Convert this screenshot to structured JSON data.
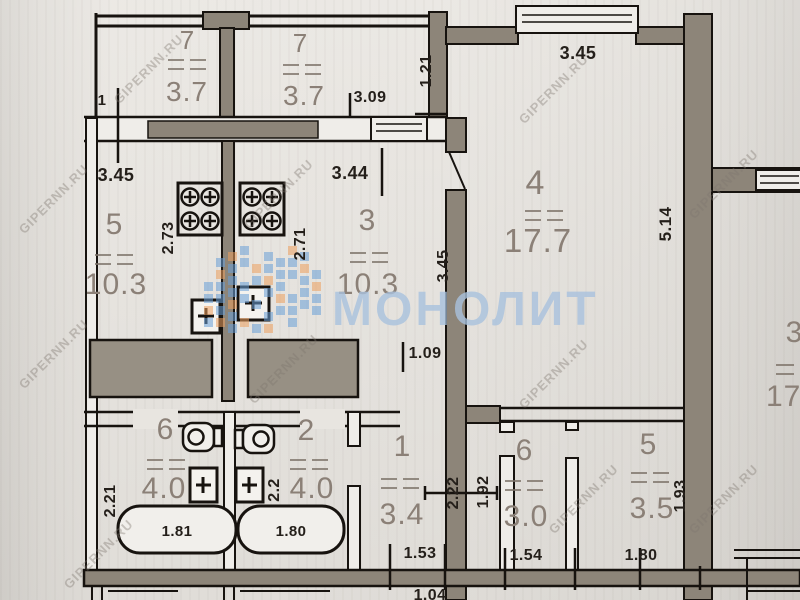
{
  "watermarks": {
    "brand_text": "МОНОЛИТ",
    "brand_color": "#a9c2de",
    "site_text": "GIPERNN.RU"
  },
  "rooms": {
    "balcony_left": {
      "number": "7",
      "area": "3.7"
    },
    "balcony_right": {
      "number": "7",
      "area": "3.7"
    },
    "room_left": {
      "number": "5",
      "area": "10.3"
    },
    "kitchen": {
      "number": "3",
      "area": "10.3"
    },
    "living": {
      "number": "4",
      "area": "17.7"
    },
    "bath_left": {
      "number": "6",
      "area": "4.0"
    },
    "bath_right": {
      "number": "2",
      "area": "4.0"
    },
    "hall": {
      "number": "1",
      "area": "3.4"
    },
    "wc_right_a": {
      "number": "6",
      "area": "3.0"
    },
    "wc_right_b": {
      "number": "5",
      "area": "3.5"
    },
    "neighbor_room": {
      "number": "3",
      "area": "17"
    }
  },
  "dims": {
    "h_345_top_left": "3.45",
    "h_344_kitchen": "3.44",
    "h_309_balcony": "3.09",
    "h_345_room4": "3.45",
    "v_121": "1.21",
    "v_273": "2.73",
    "v_271": "2.71",
    "v_345_kitchen": "3.45",
    "v_514_room4": "5.14",
    "h_109_door": "1.09",
    "tub_left": "1.81",
    "tub_right": "1.80",
    "v_221_bath": "2.21",
    "v_22_bath": "2.2",
    "v_222_hall": "2.22",
    "v_192_corridor": "1.92",
    "v_193_wc": "1.93",
    "h_153_hall": "1.53",
    "h_154_wc": "1.54",
    "h_180_wc": "1.80",
    "h_104_bottom": "1.04",
    "tick_label_1": "1"
  },
  "icons": {
    "stove": "4-burner-stove",
    "toilet": "toilet",
    "bathtub": "bathtub",
    "sink_box": "plus-box-fixture"
  },
  "colors": {
    "paper": "#e8e5e0",
    "wall_fill": "#8d8579",
    "ink": "#17130f",
    "label_gray": "#8b8077",
    "mosaic_blue": "#6aa0d8",
    "mosaic_orange": "#eda05f"
  }
}
